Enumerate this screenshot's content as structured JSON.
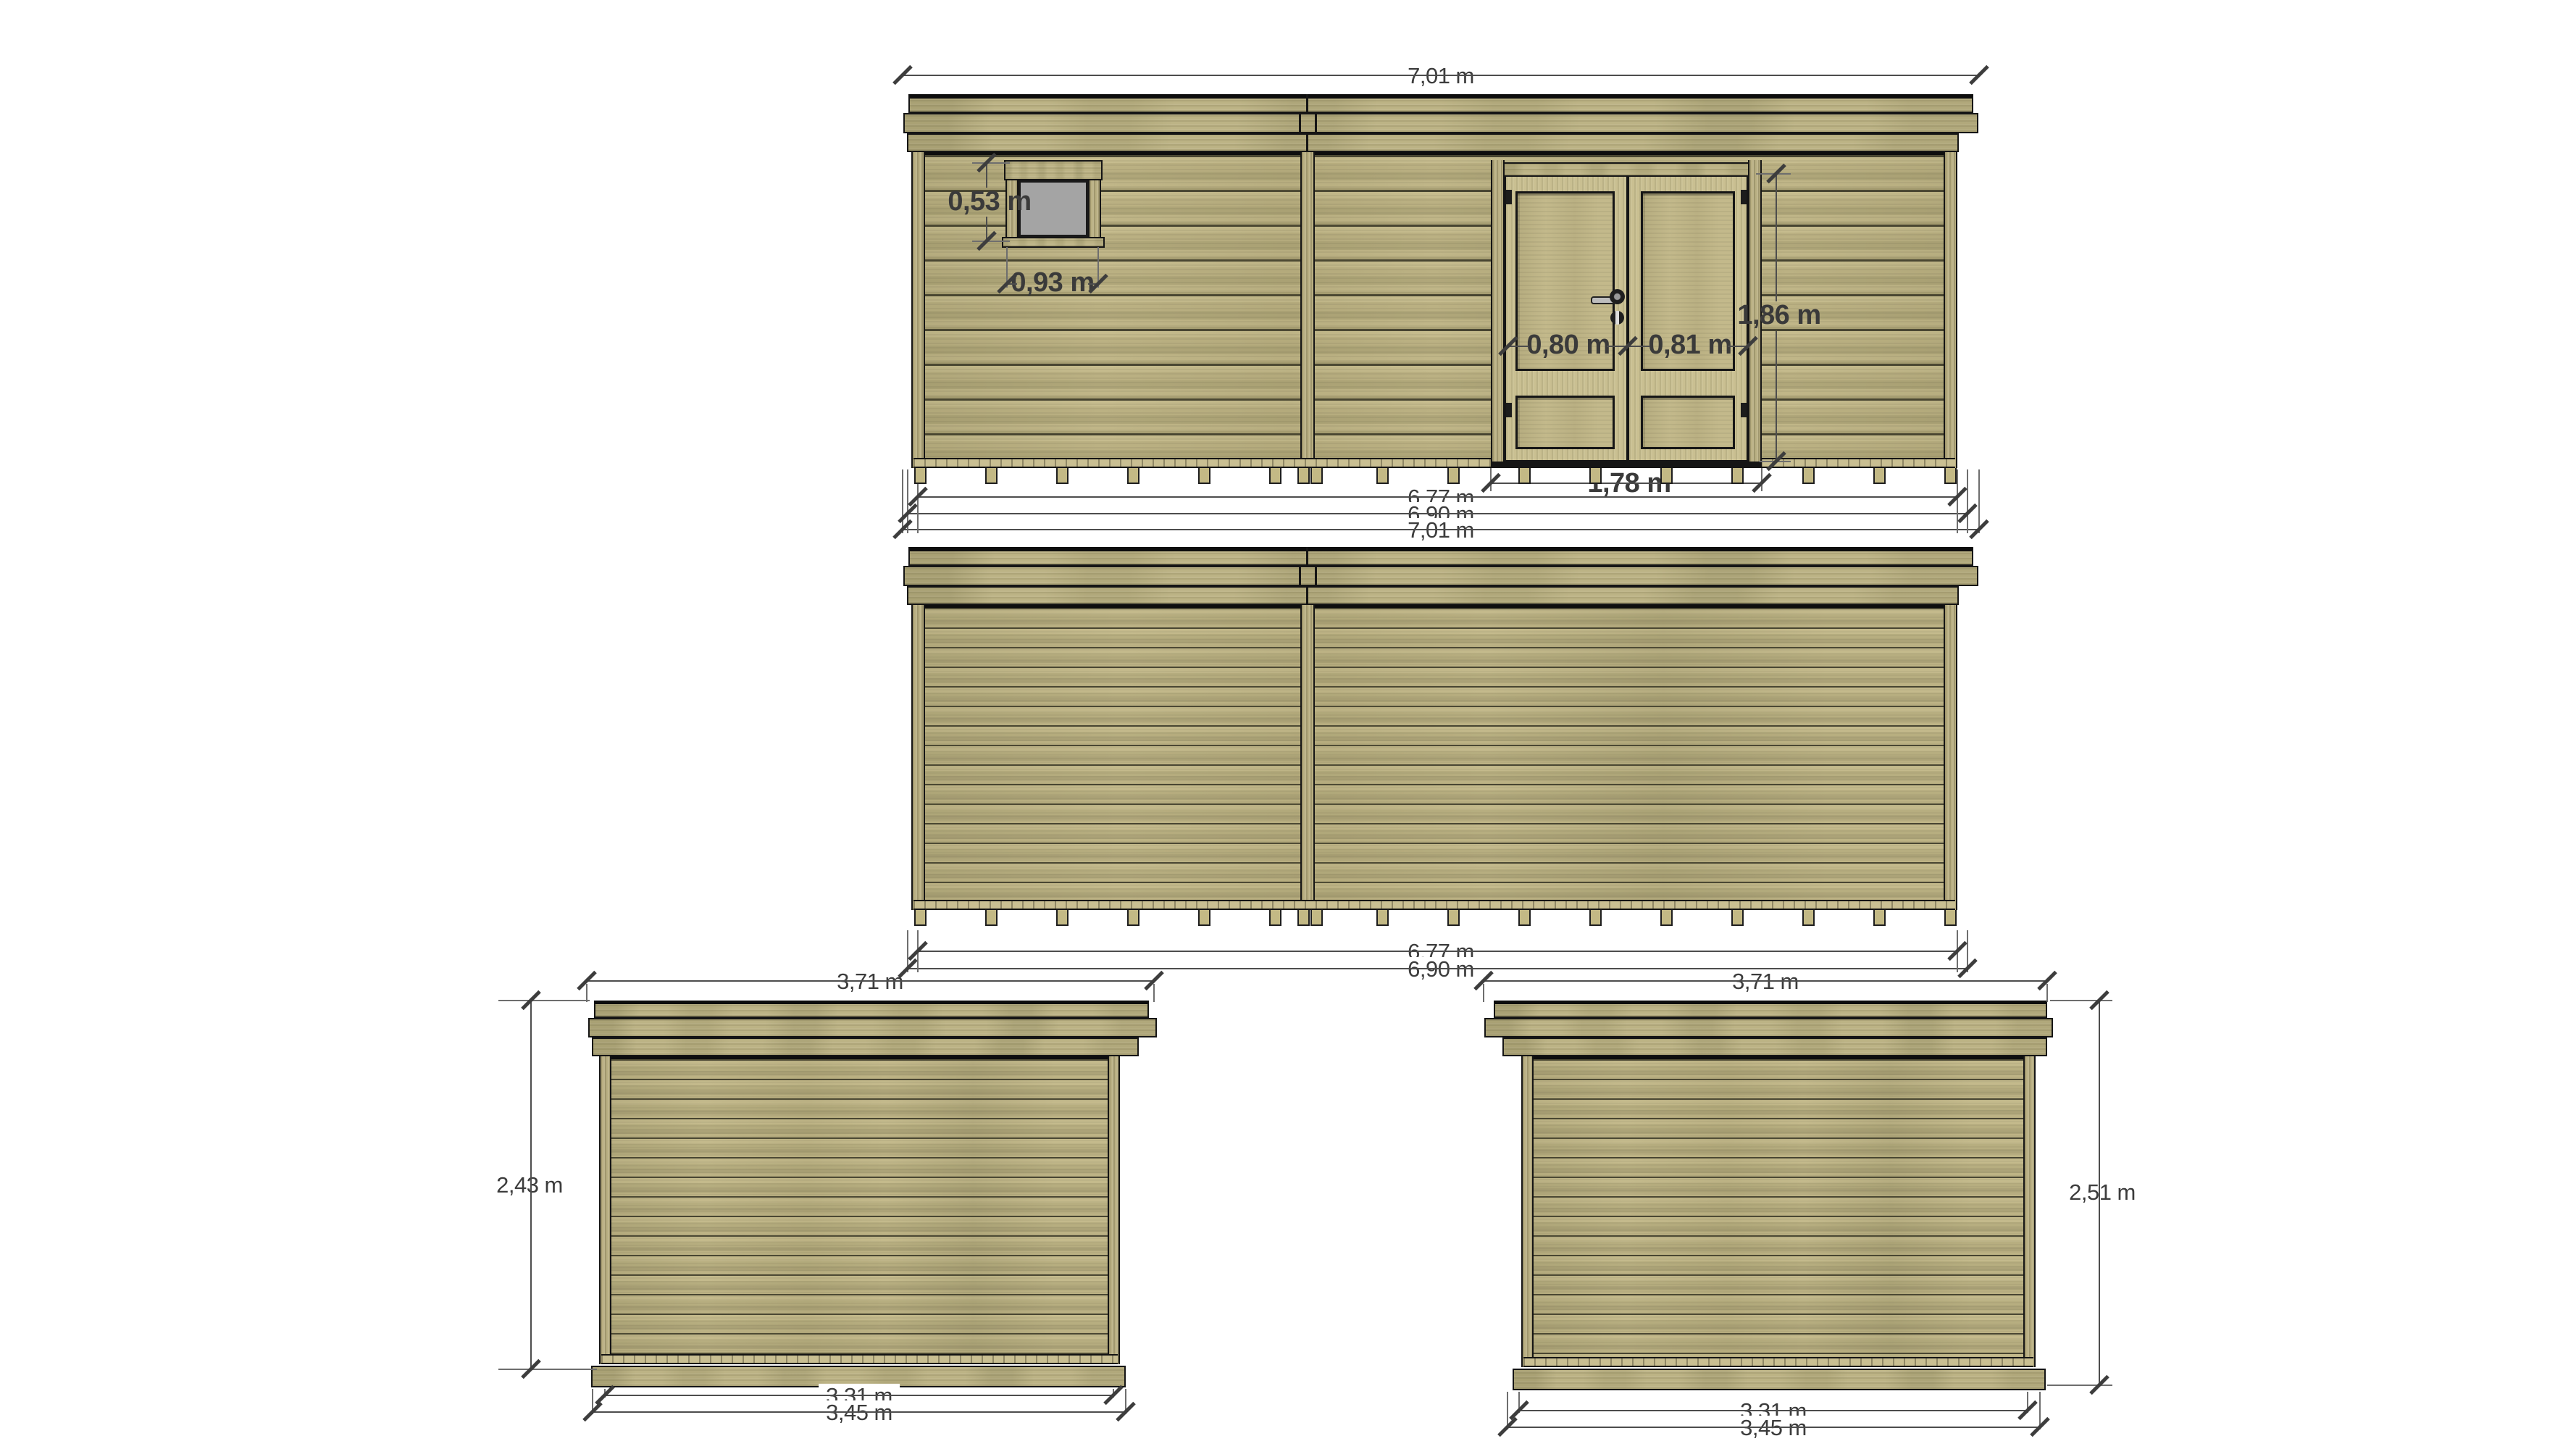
{
  "drawing": {
    "background": "#ffffff",
    "unit": "m",
    "views": {
      "front": {
        "dims": {
          "roof_width": "7,01 m",
          "window_height": "0,53 m",
          "window_width": "0,93 m",
          "door_leaf_left_width": "0,80 m",
          "door_leaf_right_width": "0,81 m",
          "door_height": "1,86 m",
          "door_width": "1,78 m",
          "wall_width": "6,77 m",
          "base_width": "6,90 m",
          "total_width": "7,01 m"
        }
      },
      "rear": {
        "dims": {
          "wall_width": "6,77 m",
          "base_width": "6,90 m"
        }
      },
      "left_side": {
        "dims": {
          "roof_depth": "3,71 m",
          "height": "2,43 m",
          "wall_depth": "3,31 m",
          "base_depth": "3,45 m"
        }
      },
      "right_side": {
        "dims": {
          "roof_depth": "3,71 m",
          "height": "2,51 m",
          "wall_depth": "3,31 m",
          "base_depth": "3,45 m"
        }
      }
    },
    "colors": {
      "wood_base": "#bcb385",
      "wood_light": "#cdc498",
      "wood_dark": "#a49b72",
      "plank_groove": "#4a4733",
      "outline": "#151515",
      "window_glass": "#a4a4a4",
      "dim_line": "#4d4d4d",
      "dim_text": "#3c3c3c",
      "handle_metal": "#bdbdbd"
    }
  }
}
